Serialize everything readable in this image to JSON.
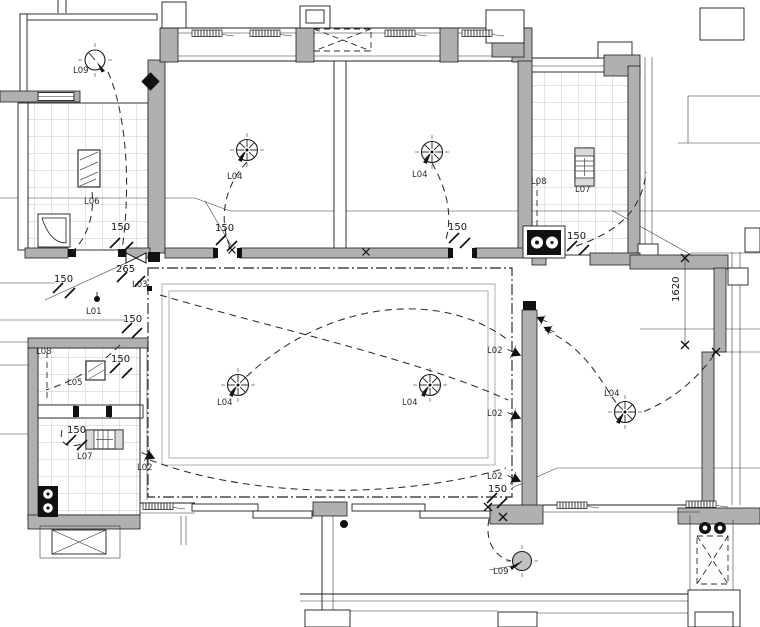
{
  "plan": {
    "colors": {
      "line": "#1d1d1d",
      "wall_fill": "#b0b0b0",
      "tile_line": "#b5b5b5",
      "inner_frame": "#9c9c9c",
      "balcony_lamp_fill": "#c2c2c2",
      "background": "#ffffff"
    },
    "labels": [
      {
        "text": "L09",
        "x": 73,
        "y": 73
      },
      {
        "text": "L06",
        "x": 84,
        "y": 204
      },
      {
        "text": "L04",
        "x": 227,
        "y": 179
      },
      {
        "text": "L04",
        "x": 412,
        "y": 177
      },
      {
        "text": "L08",
        "x": 531,
        "y": 184
      },
      {
        "text": "L07",
        "x": 575,
        "y": 192
      },
      {
        "text": "L04",
        "x": 604,
        "y": 396
      },
      {
        "text": "L04",
        "x": 217,
        "y": 405
      },
      {
        "text": "L04",
        "x": 402,
        "y": 405
      },
      {
        "text": "L03",
        "x": 132,
        "y": 287
      },
      {
        "text": "L01",
        "x": 86,
        "y": 314
      },
      {
        "text": "L02",
        "x": 137,
        "y": 470
      },
      {
        "text": "L02",
        "x": 487,
        "y": 353
      },
      {
        "text": "L02",
        "x": 487,
        "y": 416
      },
      {
        "text": "L02",
        "x": 487,
        "y": 479
      },
      {
        "text": "L08",
        "x": 36,
        "y": 354
      },
      {
        "text": "L05",
        "x": 67,
        "y": 385
      },
      {
        "text": "L07",
        "x": 77,
        "y": 459
      },
      {
        "text": "L09",
        "x": 493,
        "y": 574
      }
    ],
    "dimensions": [
      {
        "text": "150",
        "x": 111,
        "y": 230
      },
      {
        "text": "150",
        "x": 54,
        "y": 282
      },
      {
        "text": "265",
        "x": 116,
        "y": 272
      },
      {
        "text": "150",
        "x": 123,
        "y": 322
      },
      {
        "text": "150",
        "x": 215,
        "y": 231
      },
      {
        "text": "150",
        "x": 448,
        "y": 230
      },
      {
        "text": "150",
        "x": 567,
        "y": 239
      },
      {
        "text": "150",
        "x": 111,
        "y": 362
      },
      {
        "text": "150",
        "x": 67,
        "y": 433
      },
      {
        "text": "150",
        "x": 488,
        "y": 492
      },
      {
        "text": "1620",
        "x": 679,
        "y": 302,
        "rotate": -90
      }
    ],
    "symbols": [
      "ceiling-light-icon",
      "pendant-light-icon",
      "balcony-light-icon",
      "wall-light-icon",
      "point-light-icon",
      "strip-light-icon",
      "grille-light-icon",
      "bath-light-icon",
      "cooktop-icon",
      "exhaust-fan-icon",
      "shower-tray-icon",
      "ac-platform-icon",
      "duct-shaft-icon",
      "valve-icon",
      "switch-dot-icon",
      "window-coil-icon",
      "dimension-tick-icon"
    ]
  }
}
